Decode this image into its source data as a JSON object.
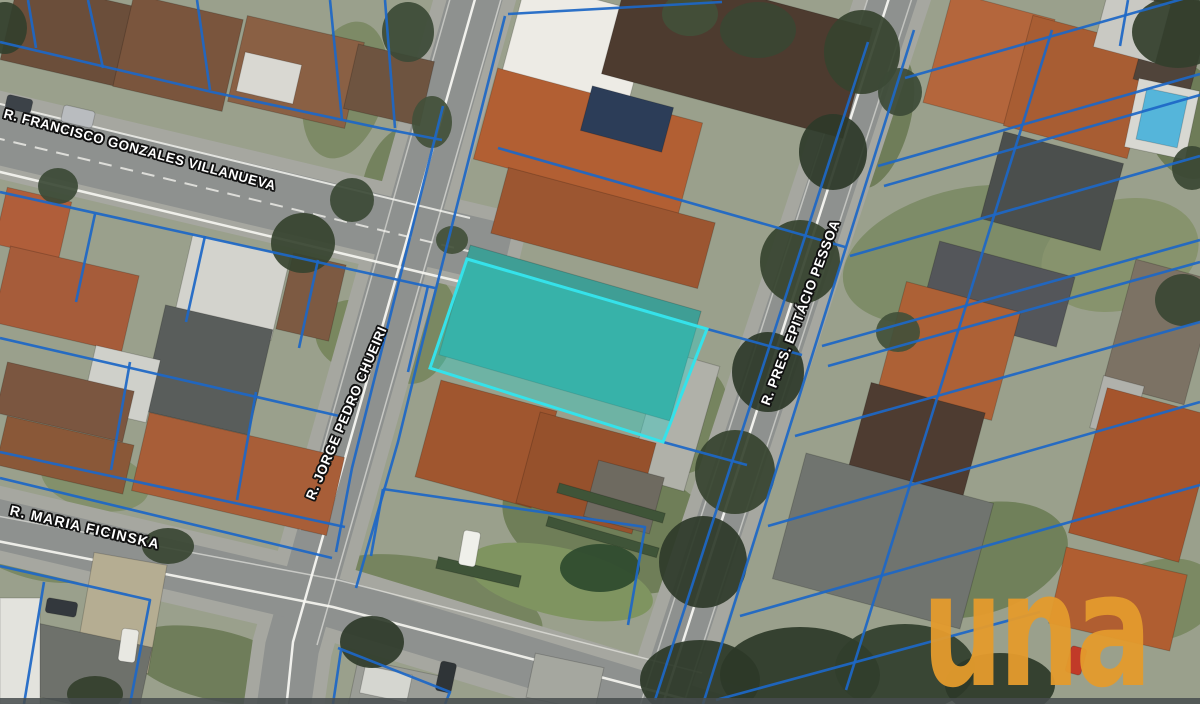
{
  "streets": [
    {
      "name": "R. FRANCISCO GONZALES VILLANUEVA"
    },
    {
      "name": "R. JORGE PEDRO CHUEIRI"
    },
    {
      "name": "R. PRES. EPITÁCIO PESSOA"
    },
    {
      "name": "R. MARIA FICINSKA"
    }
  ],
  "watermark": {
    "text": "una",
    "color": "#E49B2D"
  },
  "overlay": {
    "parcel_line_color": "#1d67c6",
    "highlight": {
      "points": [
        [
          467,
          259
        ],
        [
          707,
          329
        ],
        [
          663,
          442
        ],
        [
          430,
          368
        ]
      ],
      "fill": "#2ed0c8",
      "fill_opacity": 0.4,
      "stroke": "#35e2ea",
      "stroke_width": 3
    }
  },
  "scene": {
    "bg": "#9aa08c",
    "road_color": "#8e918f",
    "sidewalk_color": "#a6a7a0",
    "marking_color": "#f7f7f2",
    "lawns": [
      [
        345,
        90,
        40,
        70,
        15,
        "#7d8a66"
      ],
      [
        398,
        185,
        35,
        60,
        15,
        "#74825e"
      ],
      [
        470,
        45,
        26,
        40,
        15,
        "#7a8862"
      ],
      [
        880,
        120,
        30,
        70,
        15,
        "#6f7d59"
      ],
      [
        960,
        255,
        120,
        65,
        -15,
        "#7e8c68"
      ],
      [
        1120,
        255,
        80,
        55,
        -15,
        "#87936d"
      ],
      [
        905,
        475,
        60,
        45,
        -15,
        "#778560"
      ],
      [
        975,
        560,
        95,
        55,
        -15,
        "#70805a"
      ],
      [
        1160,
        600,
        60,
        40,
        -15,
        "#7b8963"
      ],
      [
        420,
        330,
        35,
        55,
        15,
        "#7a8862"
      ],
      [
        610,
        525,
        110,
        65,
        15,
        "#6f7e58"
      ],
      [
        688,
        420,
        40,
        55,
        15,
        "#76845f"
      ],
      [
        60,
        150,
        35,
        25,
        13,
        "#7d8a66"
      ],
      [
        355,
        335,
        40,
        35,
        13,
        "#79875f"
      ],
      [
        40,
        545,
        75,
        35,
        13,
        "#7b8964"
      ],
      [
        215,
        665,
        90,
        35,
        13,
        "#6f7d5a"
      ],
      [
        430,
        605,
        115,
        45,
        13,
        "#76845f"
      ],
      [
        560,
        582,
        95,
        34,
        13,
        "#7f9460"
      ],
      [
        95,
        480,
        55,
        30,
        13,
        "#83906b"
      ],
      [
        1185,
        120,
        40,
        60,
        -15,
        "#6e7c58"
      ]
    ],
    "roads": [
      {
        "id": "francisco-gonzales-villanueva",
        "pts": [
          [
            -12,
            132
          ],
          [
            478,
            248
          ]
        ],
        "w": 60
      },
      {
        "id": "jorge-pedro-chueiri",
        "pts": [
          [
            478,
            -12
          ],
          [
            292,
            648
          ],
          [
            283,
            712
          ]
        ],
        "w": 54
      },
      {
        "id": "pres-epitacio-pessoa",
        "pts": [
          [
            896,
            -12
          ],
          [
            658,
            712
          ]
        ],
        "w": 48
      },
      {
        "id": "maria-ficinska",
        "pts": [
          [
            -12,
            522
          ],
          [
            330,
            602
          ],
          [
            700,
            714
          ]
        ],
        "w": 50
      }
    ],
    "road_lines": [
      {
        "pts": [
          [
            -8,
            102
          ],
          [
            470,
            218
          ]
        ],
        "w": 2,
        "o": 0.8
      },
      {
        "pts": [
          [
            -8,
            170
          ],
          [
            474,
            285
          ]
        ],
        "w": 2.5,
        "o": 0.9
      },
      {
        "pts": [
          [
            -8,
            137
          ],
          [
            472,
            252
          ]
        ],
        "w": 2,
        "o": 0.75,
        "dash": "13 9"
      },
      {
        "pts": [
          [
            477,
            -8
          ],
          [
            293,
            642
          ],
          [
            286,
            710
          ]
        ],
        "w": 2.5,
        "o": 0.95
      },
      {
        "pts": [
          [
            452,
            -8
          ],
          [
            300,
            530
          ]
        ],
        "w": 1.5,
        "o": 0.5
      },
      {
        "pts": [
          [
            503,
            -8
          ],
          [
            317,
            645
          ]
        ],
        "w": 1.5,
        "o": 0.55
      },
      {
        "pts": [
          [
            891,
            -8
          ],
          [
            661,
            710
          ]
        ],
        "w": 2.5,
        "o": 0.95
      },
      {
        "pts": [
          [
            870,
            -8
          ],
          [
            640,
            706
          ]
        ],
        "w": 1.5,
        "o": 0.5
      },
      {
        "pts": [
          [
            914,
            -8
          ],
          [
            683,
            706
          ]
        ],
        "w": 1.5,
        "o": 0.5
      },
      {
        "pts": [
          [
            -8,
            540
          ],
          [
            333,
            607
          ],
          [
            696,
            702
          ]
        ],
        "w": 2.5,
        "o": 0.9
      },
      {
        "pts": [
          [
            -8,
            515
          ],
          [
            338,
            580
          ],
          [
            702,
            673
          ]
        ],
        "w": 1.5,
        "o": 0.55
      }
    ],
    "buildings": [
      [
        8,
        -8,
        118,
        82,
        13,
        "#6b4e3a"
      ],
      [
        122,
        6,
        112,
        94,
        13,
        "#7a553d"
      ],
      [
        236,
        28,
        120,
        88,
        13,
        "#8a6044"
      ],
      [
        350,
        52,
        78,
        66,
        13,
        "#6e5440"
      ],
      [
        240,
        58,
        58,
        40,
        13,
        "#d9d8d2"
      ],
      [
        0,
        194,
        66,
        58,
        13,
        "#b05e3a"
      ],
      [
        0,
        260,
        132,
        78,
        13,
        "#a65c3a"
      ],
      [
        182,
        244,
        100,
        86,
        13,
        "#d3d3cd"
      ],
      [
        284,
        258,
        54,
        78,
        13,
        "#7d5a42"
      ],
      [
        152,
        316,
        110,
        108,
        13,
        "#595d5b"
      ],
      [
        88,
        352,
        66,
        64,
        13,
        "#cfd0ca"
      ],
      [
        0,
        376,
        130,
        52,
        13,
        "#7b5640"
      ],
      [
        0,
        430,
        130,
        50,
        13,
        "#8a5838"
      ],
      [
        138,
        434,
        200,
        80,
        13,
        "#a85e38"
      ],
      [
        84,
        558,
        74,
        110,
        10,
        "#b5ad92",
        "driveway"
      ],
      [
        24,
        634,
        122,
        72,
        12,
        "#6e716b"
      ],
      [
        0,
        598,
        40,
        106,
        0,
        "#e3e3dd"
      ],
      [
        645,
        356,
        58,
        130,
        16,
        "#b0b1a9",
        "driveway"
      ],
      [
        512,
        -4,
        130,
        94,
        15,
        "#edebe5"
      ],
      [
        612,
        -6,
        250,
        114,
        15,
        "#4d3b2f"
      ],
      [
        482,
        94,
        212,
        94,
        15,
        "#b25f33"
      ],
      [
        585,
        96,
        84,
        46,
        15,
        "#2c3d58",
        "solar-panels"
      ],
      [
        496,
        194,
        214,
        68,
        15,
        "#9c5631"
      ],
      [
        450,
        276,
        240,
        114,
        16,
        "#3f9e95",
        "teal-roof-building"
      ],
      [
        426,
        394,
        120,
        100,
        15,
        "#a0562f"
      ],
      [
        526,
        426,
        120,
        94,
        15,
        "#96512c"
      ],
      [
        590,
        468,
        68,
        58,
        15,
        "#6e6a60"
      ],
      [
        436,
        566,
        85,
        12,
        13,
        "#3f5438",
        "hedge"
      ],
      [
        556,
        498,
        110,
        10,
        16,
        "#3f5438",
        "hedge"
      ],
      [
        545,
        532,
        115,
        10,
        16,
        "#3f5438",
        "hedge"
      ],
      [
        352,
        668,
        95,
        50,
        12,
        "#9b9d97"
      ],
      [
        362,
        670,
        48,
        28,
        12,
        "#d5d6d0"
      ],
      [
        530,
        660,
        70,
        45,
        12,
        "#a5a79f"
      ],
      [
        936,
        4,
        106,
        114,
        15,
        "#b4663c"
      ],
      [
        1016,
        30,
        128,
        114,
        15,
        "#a85d33"
      ],
      [
        1144,
        -4,
        58,
        92,
        15,
        "#50443a"
      ],
      [
        1100,
        -4,
        64,
        60,
        15,
        "#c9c9c3"
      ],
      [
        1131,
        84,
        62,
        70,
        12,
        "#d8d8d2",
        "pool-deck"
      ],
      [
        1141,
        92,
        42,
        52,
        12,
        "#55b5da",
        "pool"
      ],
      [
        990,
        146,
        124,
        90,
        15,
        "#4b4f4d"
      ],
      [
        928,
        258,
        140,
        72,
        15,
        "#54565a"
      ],
      [
        890,
        295,
        118,
        112,
        15,
        "#ad6136"
      ],
      [
        1118,
        268,
        84,
        128,
        15,
        "#7c7264"
      ],
      [
        1096,
        380,
        42,
        54,
        15,
        "#b0b1ab"
      ],
      [
        856,
        396,
        118,
        102,
        15,
        "#4e3c31"
      ],
      [
        786,
        476,
        194,
        130,
        15,
        "#70746f"
      ],
      [
        1086,
        400,
        114,
        150,
        15,
        "#a5552d"
      ],
      [
        1056,
        560,
        124,
        78,
        13,
        "#b05e31"
      ],
      [
        62,
        108,
        32,
        17,
        13,
        "#b9bcbf",
        "car"
      ],
      [
        6,
        97,
        26,
        14,
        13,
        "#3c4248",
        "car"
      ],
      [
        461,
        531,
        17,
        35,
        10,
        "#eff0ea",
        "car"
      ],
      [
        120,
        629,
        17,
        33,
        8,
        "#e8e8e2",
        "car"
      ],
      [
        46,
        600,
        31,
        15,
        10,
        "#33383d",
        "car"
      ],
      [
        1068,
        647,
        16,
        27,
        15,
        "#c13a28",
        "car"
      ],
      [
        438,
        662,
        16,
        30,
        12,
        "#2f3437",
        "car"
      ]
    ],
    "trees": [
      [
        408,
        32,
        26,
        30,
        "#3c4a36"
      ],
      [
        432,
        122,
        20,
        26,
        "#42503a"
      ],
      [
        303,
        243,
        32,
        30,
        "#36432f"
      ],
      [
        352,
        200,
        22,
        22,
        "#3c4a36"
      ],
      [
        5,
        28,
        22,
        26,
        "#333f2d"
      ],
      [
        862,
        52,
        38,
        42,
        "#36432f"
      ],
      [
        833,
        152,
        34,
        38,
        "#2e3a29"
      ],
      [
        800,
        262,
        40,
        42,
        "#36432f"
      ],
      [
        768,
        372,
        36,
        40,
        "#2e3a29"
      ],
      [
        735,
        472,
        40,
        42,
        "#36432f"
      ],
      [
        703,
        562,
        44,
        46,
        "#2e3a29"
      ],
      [
        900,
        92,
        22,
        24,
        "#3c4a36"
      ],
      [
        700,
        680,
        60,
        40,
        "#2c3828"
      ],
      [
        800,
        675,
        80,
        48,
        "#2c3828"
      ],
      [
        905,
        668,
        70,
        44,
        "#313e2c"
      ],
      [
        1000,
        685,
        55,
        32,
        "#2c3828"
      ],
      [
        758,
        30,
        38,
        28,
        "#3a4733"
      ],
      [
        690,
        14,
        28,
        22,
        "#42503a"
      ],
      [
        1183,
        300,
        28,
        26,
        "#3a4733"
      ],
      [
        898,
        332,
        22,
        20,
        "#42503a"
      ],
      [
        1192,
        168,
        20,
        22,
        "#3a4733"
      ],
      [
        58,
        186,
        20,
        18,
        "#3c4a36"
      ],
      [
        168,
        546,
        26,
        18,
        "#3a4733"
      ],
      [
        372,
        642,
        32,
        26,
        "#2f3b2a"
      ],
      [
        95,
        694,
        28,
        18,
        "#333f2d"
      ],
      [
        600,
        568,
        40,
        24,
        "#2e4a2e"
      ],
      [
        1178,
        32,
        46,
        36,
        "#333f2d"
      ],
      [
        452,
        240,
        16,
        14,
        "#42503a"
      ]
    ],
    "parcels": [
      [
        [
          0,
          42
        ],
        [
          212,
          92
        ],
        [
          380,
          128
        ],
        [
          442,
          140
        ]
      ],
      [
        [
          88,
          0
        ],
        [
          103,
          68
        ]
      ],
      [
        [
          197,
          0
        ],
        [
          210,
          90
        ]
      ],
      [
        [
          330,
          0
        ],
        [
          342,
          120
        ]
      ],
      [
        [
          385,
          0
        ],
        [
          395,
          128
        ]
      ],
      [
        [
          28,
          0
        ],
        [
          36,
          48
        ]
      ],
      [
        [
          0,
          192
        ],
        [
          435,
          288
        ]
      ],
      [
        [
          95,
          214
        ],
        [
          76,
          302
        ]
      ],
      [
        [
          205,
          236
        ],
        [
          186,
          322
        ]
      ],
      [
        [
          318,
          260
        ],
        [
          299,
          348
        ]
      ],
      [
        [
          428,
          286
        ],
        [
          408,
          372
        ]
      ],
      [
        [
          0,
          338
        ],
        [
          348,
          418
        ]
      ],
      [
        [
          0,
          452
        ],
        [
          345,
          527
        ]
      ],
      [
        [
          130,
          362
        ],
        [
          111,
          470
        ]
      ],
      [
        [
          256,
          392
        ],
        [
          237,
          500
        ]
      ],
      [
        [
          443,
          106
        ],
        [
          352,
          468
        ],
        [
          336,
          552
        ]
      ],
      [
        [
          0,
          566
        ],
        [
          150,
          600
        ],
        [
          130,
          704
        ]
      ],
      [
        [
          44,
          582
        ],
        [
          24,
          704
        ]
      ],
      [
        [
          0,
          478
        ],
        [
          332,
          558
        ]
      ],
      [
        [
          505,
          16
        ],
        [
          420,
          352
        ],
        [
          398,
          442
        ],
        [
          356,
          588
        ]
      ],
      [
        [
          508,
          14
        ],
        [
          722,
          2
        ]
      ],
      [
        [
          498,
          148
        ],
        [
          845,
          247
        ]
      ],
      [
        [
          868,
          42
        ],
        [
          655,
          700
        ]
      ],
      [
        [
          914,
          30
        ],
        [
          703,
          704
        ]
      ],
      [
        [
          707,
          329
        ],
        [
          802,
          355
        ]
      ],
      [
        [
          663,
          442
        ],
        [
          747,
          465
        ]
      ],
      [
        [
          383,
          489
        ],
        [
          645,
          527
        ],
        [
          628,
          625
        ]
      ],
      [
        [
          383,
          489
        ],
        [
          371,
          556
        ]
      ],
      [
        [
          1052,
          30
        ],
        [
          846,
          690
        ]
      ],
      [
        [
          905,
          78
        ],
        [
          1200,
          -6
        ]
      ],
      [
        [
          878,
          166
        ],
        [
          1200,
          74
        ]
      ],
      [
        [
          884,
          186
        ],
        [
          1200,
          95
        ]
      ],
      [
        [
          850,
          256
        ],
        [
          1200,
          156
        ]
      ],
      [
        [
          822,
          346
        ],
        [
          1200,
          240
        ]
      ],
      [
        [
          828,
          366
        ],
        [
          1200,
          262
        ]
      ],
      [
        [
          795,
          436
        ],
        [
          1200,
          322
        ]
      ],
      [
        [
          768,
          526
        ],
        [
          1200,
          402
        ]
      ],
      [
        [
          740,
          616
        ],
        [
          1200,
          485
        ]
      ],
      [
        [
          716,
          700
        ],
        [
          1040,
          612
        ]
      ],
      [
        [
          1128,
          0
        ],
        [
          1120,
          46
        ]
      ],
      [
        [
          338,
          648
        ],
        [
          450,
          692
        ],
        [
          445,
          704
        ]
      ],
      [
        [
          341,
          650
        ],
        [
          333,
          704
        ]
      ]
    ]
  }
}
